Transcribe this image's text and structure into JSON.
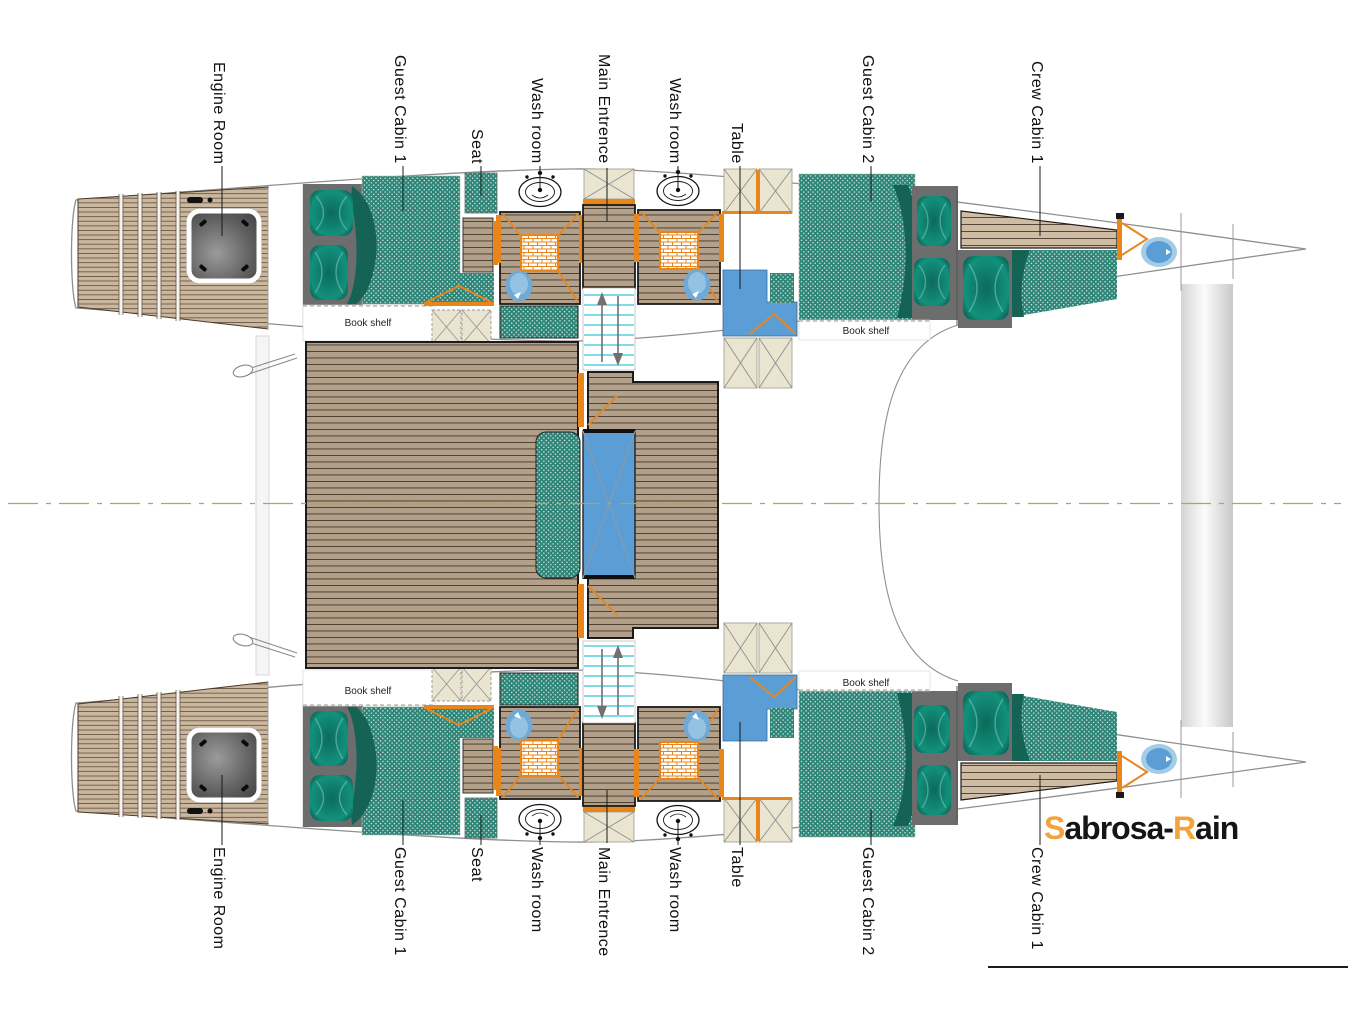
{
  "plan_labels": {
    "top": [
      "Engine Room",
      "Guest Cabin 1",
      "Seat",
      "Wash room",
      "Main Entrence",
      "Wash room",
      "Table",
      "Guest Cabin 2",
      "Crew Cabin 1"
    ],
    "bottom": [
      "Engine Room",
      "Guest Cabin 1",
      "Seat",
      "Wash room",
      "Main Entrence",
      "Wash room",
      "Table",
      "Guest Cabin 2",
      "Crew Cabin 1"
    ]
  },
  "book_shelf_label": "Book shelf",
  "logo": {
    "part1": "S",
    "part2": "abrosa-",
    "part3": "R",
    "part4": "ain"
  },
  "colors": {
    "teal_upholstery": "#2e8577",
    "teal_dark": "#156355",
    "wood_plank": "#b2a08b",
    "aft_deck": "#cab79e",
    "step_wood": "#cfbca4",
    "orange_fittings": "#e8861c",
    "table_blue": "#5b9ed6",
    "stair_cyan": "#56cfe2",
    "hatch_beige": "#e9e5d1",
    "headboard_gray": "#6d6d6d",
    "hull_outline": "#8f8f8f",
    "centerline_green": "#a4b047",
    "logo_orange": "#f2a33c"
  },
  "icons": {
    "sink": "sink-icon",
    "toilet": "toilet-icon",
    "shower": "shower-tray-icon",
    "stairs": "staircase-icon",
    "deck_hatch": "deck-hatch-icon",
    "engine_hatch": "engine-hatch-icon",
    "door_swing": "door-swing-icon",
    "pillow": "pillow-icon",
    "cleat": "mooring-cleat-icon"
  }
}
